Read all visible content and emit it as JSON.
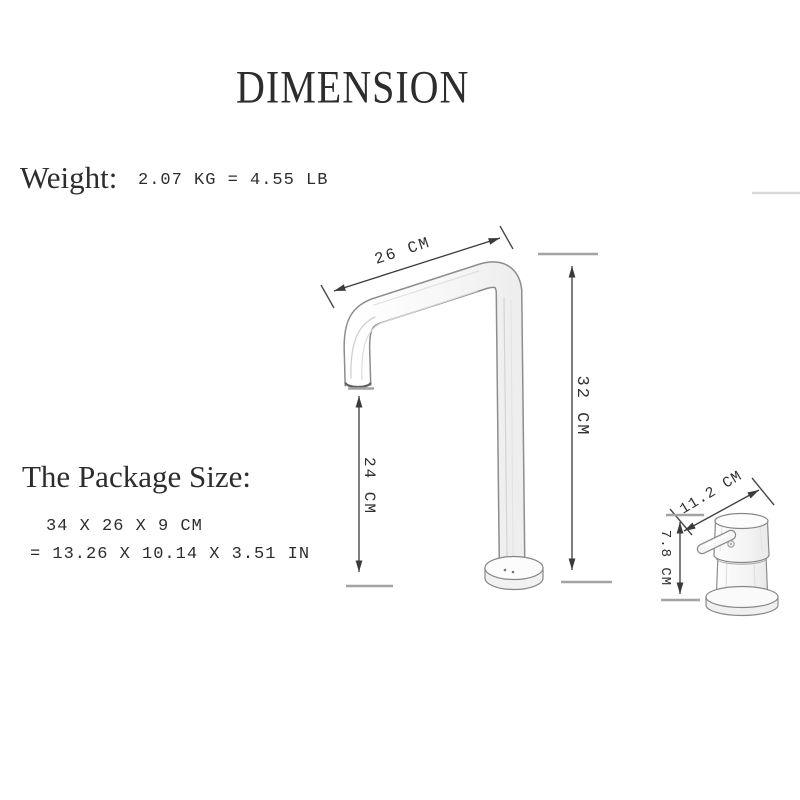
{
  "title": "DIMENSION",
  "weight": {
    "label": "Weight:",
    "value": "2.07 KG = 4.55 LB"
  },
  "package": {
    "label": "The Package Size:",
    "size_cm": "34 X 26 X 9 CM",
    "size_in": "= 13.26 X 10.14 X 3.51 IN"
  },
  "dimensions": {
    "spout_length": "26 CM",
    "total_height": "32 CM",
    "spout_clearance": "24 CM",
    "handle_length": "11.2 CM",
    "handle_height": "7.8 CM"
  },
  "colors": {
    "text": "#2d2d2d",
    "dimension_line": "#3a3a3a",
    "drawing_outline": "#8a8a8a",
    "faint_line": "#d9d9d9"
  }
}
